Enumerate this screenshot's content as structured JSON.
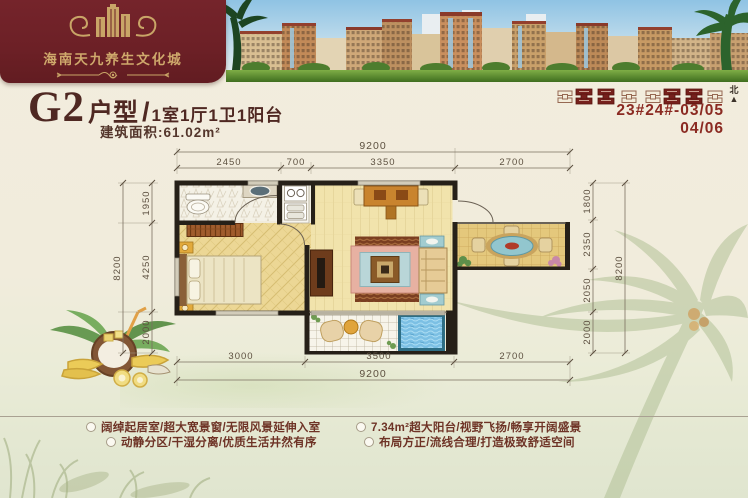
{
  "brand": {
    "name": "海南天九养生文化城"
  },
  "title": {
    "code": "G2",
    "type_label": "户型",
    "separator": "/",
    "layout": "1室1厅1卫1阳台",
    "area_text": "建筑面积:61.02m²"
  },
  "units": {
    "line1": "23#24#-03/05",
    "line2": "04/06",
    "north_label": "北",
    "north_arrow": "▲"
  },
  "plan": {
    "dims": {
      "top_total": "9200",
      "top_segments": [
        "2450",
        "700",
        "3350",
        "2700"
      ],
      "bottom_segments": [
        "3000",
        "3500",
        "2700"
      ],
      "bottom_total": "9200",
      "left_segments": [
        "1950",
        "4250",
        "2000"
      ],
      "left_total": "8200",
      "right_segments": [
        "1800",
        "2350",
        "2050",
        "2000"
      ],
      "right_total": "8200"
    }
  },
  "features": [
    {
      "text": "阔绰起居室/超大宽景窗/无限风景延伸入室"
    },
    {
      "text": "动静分区/干湿分离/优质生活井然有序"
    },
    {
      "text": "7.34m²超大阳台/视野飞扬/畅享开阔盛景"
    },
    {
      "text": "布局方正/流线合理/打造极致舒适空间"
    }
  ],
  "colors": {
    "banner_maroon": "#6c2026",
    "gold": "#cfa96c",
    "title_brown": "#4f2822",
    "unit_red": "#8b2a22",
    "feature_brown": "#6e3326",
    "wall_black": "#262018",
    "pool_blue": "#7cc0e4"
  }
}
